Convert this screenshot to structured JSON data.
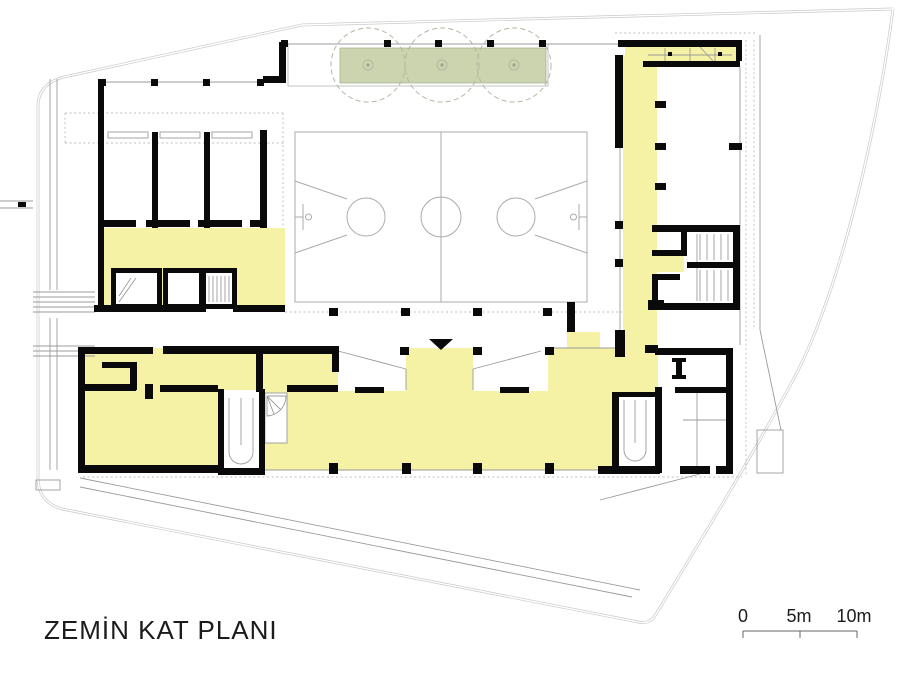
{
  "plan": {
    "title": "ZEMİN KAT PLANI"
  },
  "scale_bar": {
    "labels": [
      "0",
      "5m",
      "10m"
    ]
  },
  "colors": {
    "circulation_yellow": "#F5F1A5",
    "planter_green": "#CBD4AE",
    "wall_black": "#0a0a0a",
    "court_line_gray": "#A9ACA9",
    "site_line_gray": "#C9C9C9",
    "detail_line_gray": "#9B9B9B",
    "tree_line_green": "#AFB9A1",
    "tree_mark_green": "#9AA78B"
  },
  "icons": {
    "tree": "tree-icon",
    "entrance_marker": "entrance-triangle-icon"
  }
}
